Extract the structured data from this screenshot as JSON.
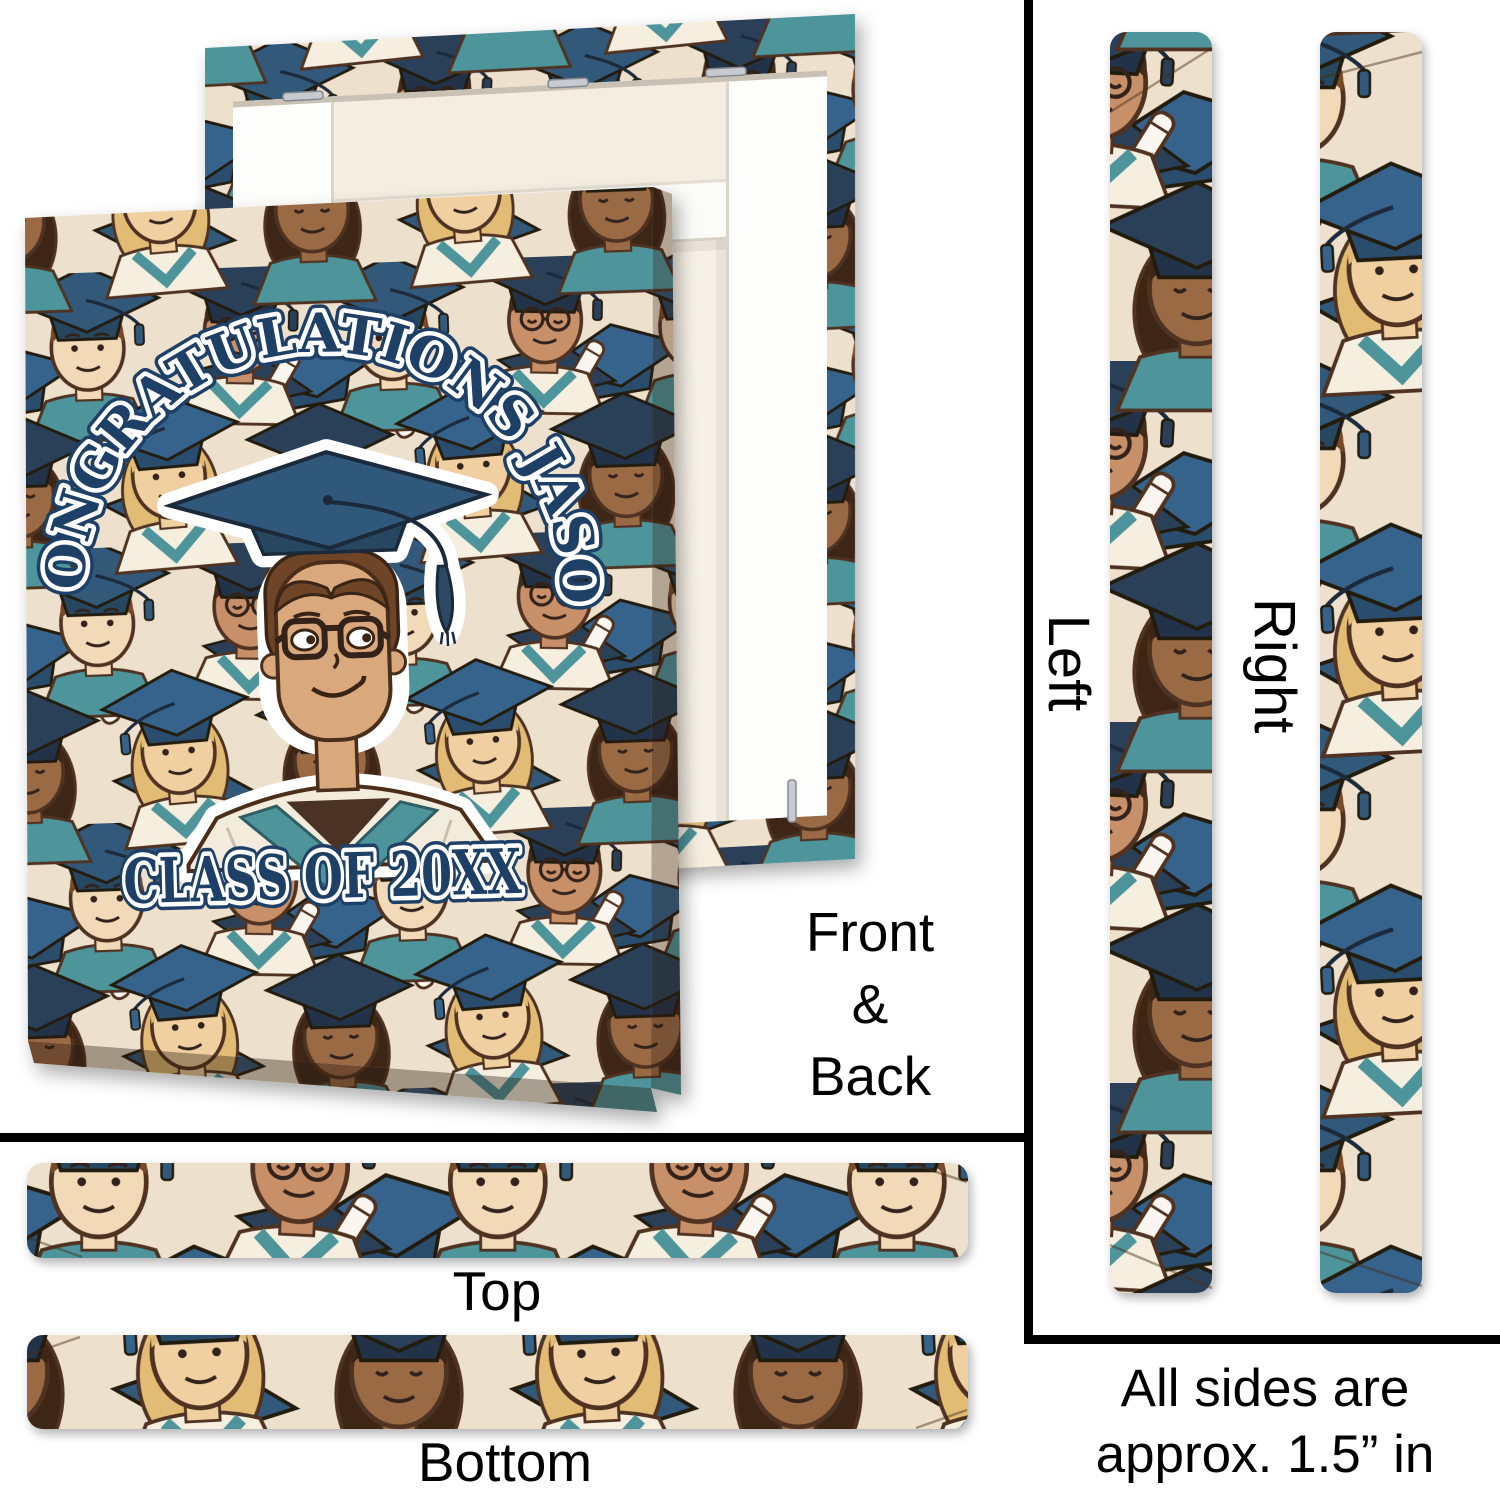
{
  "design": {
    "arc_text": "CONGRATULATIONS JASON",
    "class_text": "CLASS OF 20XX"
  },
  "labels": {
    "front_back": [
      "Front",
      "&",
      "Back"
    ],
    "left": "Left",
    "right": "Right",
    "top": "Top",
    "bottom": "Bottom"
  },
  "note": {
    "lines": [
      "All sides are",
      "approx. 1.5” in"
    ]
  },
  "colors": {
    "text_navy": "#1F4066",
    "cap_blue": "#30587A",
    "cap_navy": "#2B4159",
    "teal": "#4E949B",
    "pattern_cream": "#EDE0CC",
    "divider": "#000000"
  },
  "icons": {
    "sticker": "graduate-with-cap-icon",
    "pattern": "graduates-crowd-pattern"
  }
}
